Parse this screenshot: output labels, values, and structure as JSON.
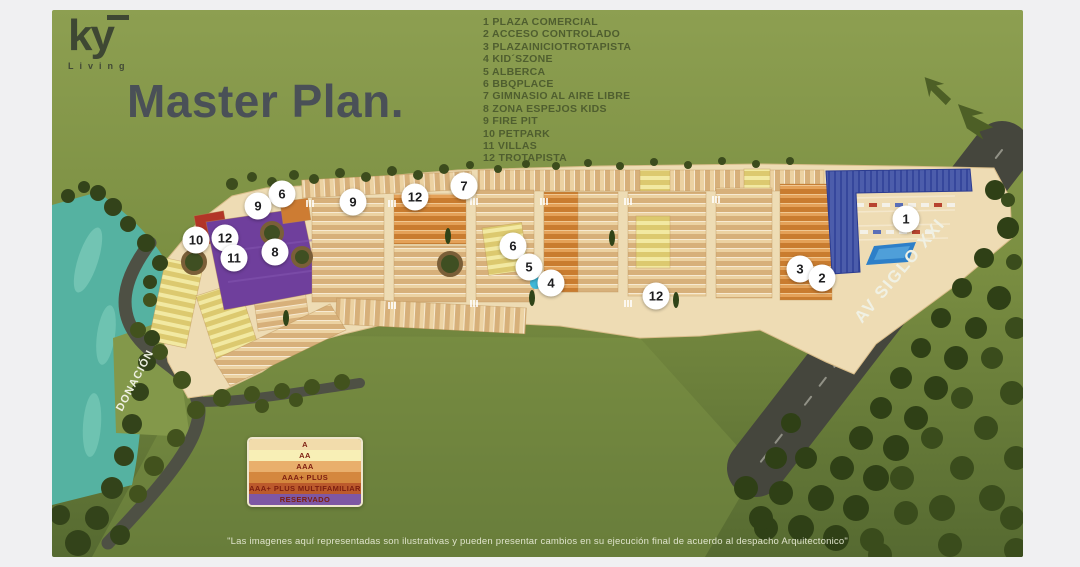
{
  "header": {
    "logo_text": "ky",
    "logo_subtext": "Living",
    "title": "Master Plan."
  },
  "amenities_legend": {
    "items": [
      {
        "num": "1",
        "label": "PLAZA COMERCIAL"
      },
      {
        "num": "2",
        "label": "ACCESO CONTROLADO"
      },
      {
        "num": "3",
        "label": "PLAZAINICIOTROTAPISTA"
      },
      {
        "num": "4",
        "label": "KID´SZONE"
      },
      {
        "num": "5",
        "label": "ALBERCA"
      },
      {
        "num": "6",
        "label": "BBQPLACE"
      },
      {
        "num": "7",
        "label": "GIMNASIO AL AIRE LIBRE"
      },
      {
        "num": "8",
        "label": "ZONA ESPEJOS KIDS"
      },
      {
        "num": "9",
        "label": "FIRE PIT"
      },
      {
        "num": "10",
        "label": "PETPARK"
      },
      {
        "num": "11",
        "label": "VILLAS"
      },
      {
        "num": "12",
        "label": "TROTAPISTA"
      }
    ]
  },
  "map": {
    "road_labels": {
      "avenue": "AV SIGLO XXI",
      "donation": "DONACIÓN"
    },
    "markers": [
      {
        "n": "1",
        "x": 906,
        "y": 219
      },
      {
        "n": "3",
        "x": 800,
        "y": 269
      },
      {
        "n": "2",
        "x": 822,
        "y": 278
      },
      {
        "n": "6",
        "x": 513,
        "y": 246
      },
      {
        "n": "5",
        "x": 529,
        "y": 267
      },
      {
        "n": "4",
        "x": 551,
        "y": 283
      },
      {
        "n": "7",
        "x": 464,
        "y": 186
      },
      {
        "n": "9",
        "x": 353,
        "y": 202
      },
      {
        "n": "12",
        "x": 415,
        "y": 197
      },
      {
        "n": "12",
        "x": 656,
        "y": 296
      },
      {
        "n": "6",
        "x": 282,
        "y": 194
      },
      {
        "n": "9",
        "x": 258,
        "y": 206
      },
      {
        "n": "8",
        "x": 275,
        "y": 252
      },
      {
        "n": "10",
        "x": 196,
        "y": 240
      },
      {
        "n": "12",
        "x": 225,
        "y": 238
      },
      {
        "n": "11",
        "x": 234,
        "y": 258
      }
    ]
  },
  "category_legend": {
    "text_color": "#7c1d10",
    "bands": [
      {
        "label": "A",
        "color": "#f2dcab"
      },
      {
        "label": "AA",
        "color": "#f8efb6"
      },
      {
        "label": "AAA",
        "color": "#e9af6c"
      },
      {
        "label": "AAA+ PLUS",
        "color": "#d4873e"
      },
      {
        "label": "AAA+ PLUS MULTIFAMILIAR",
        "color": "#bc5a2c"
      },
      {
        "label": "RESERVADO",
        "color": "#7e57a4"
      }
    ]
  },
  "disclaimer": "\"Las imagenes aquí representadas son ilustrativas y pueden presentar cambios en su ejecución final de acuerdo al despacho Arquitectonico\""
}
